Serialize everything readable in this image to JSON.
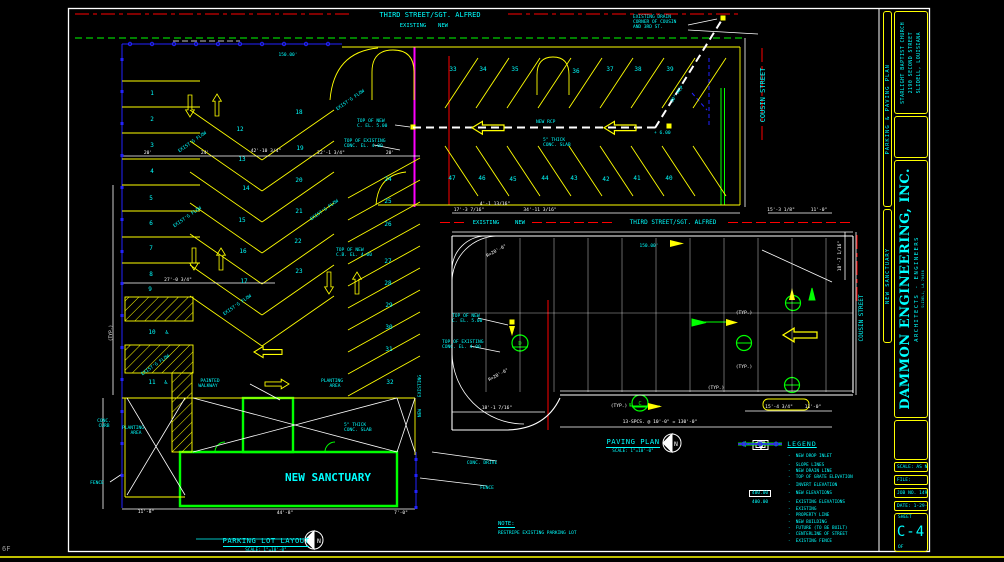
{
  "page": {
    "corner_note": "6F",
    "bg": "#000000"
  },
  "colors": {
    "cyan": "#00ffff",
    "yellow": "#ffff00",
    "green": "#00ff00",
    "red": "#ff0000",
    "magenta": "#ff00ff",
    "blue": "#2222ff",
    "white": "#ffffff"
  },
  "titleblock": {
    "project": "PARKING & PAVING PLAN",
    "drawing": "NEW SANCTUARY",
    "client": [
      "STARLIGHT BAPTIST CHURCH",
      "2190 SECOND STREET",
      "SLIDELL, LOUISIANA"
    ],
    "firm": "DAMMON ENGINEERING, INC.",
    "firm_sub": "ARCHITECTS - ENGINEERS",
    "firm_addr": "SLIDELL, LA 70458",
    "scale": "SCALE: AS NOTED",
    "file": "FILE:",
    "job": "JOB NO. 1495a",
    "date": "DATE: 1-29-04",
    "sheet_label": "SHEET",
    "sheet": "C-4",
    "of": "OF"
  },
  "plans": [
    {
      "name": "PARKING LOT LAYOUT",
      "scale": "SCALE: 1\"=10'-0\"",
      "north": "N"
    },
    {
      "name": "PAVING PLAN",
      "scale": "SCALE: 1\"=10'-0\"",
      "north": "N"
    }
  ],
  "note": {
    "title": "NOTE:",
    "body": "RESTRIPE EXISTING PARKING LOT"
  },
  "legend": {
    "title": "LEGEND",
    "items": [
      {
        "key": "drop-inlet",
        "label": "NEW DROP INLET"
      },
      {
        "key": "slope",
        "label": "SLOPE LINES"
      },
      {
        "key": "drain",
        "label": "NEW DRAIN LINE"
      },
      {
        "key": "grate",
        "label": "TOP OF GRATE ELEVATION"
      },
      {
        "key": "invert",
        "label": "INVERT ELEVATION"
      },
      {
        "key": "new-elev",
        "label": "NEW ELEVATIONS",
        "sample": "400.00"
      },
      {
        "key": "exist-elev",
        "label": "EXISTING ELEVATIONS",
        "sample": "400.00"
      },
      {
        "key": "existing",
        "label": "EXISTING"
      },
      {
        "key": "property",
        "label": "PROPERTY LINE"
      },
      {
        "key": "building",
        "label": "NEW BUILDING"
      },
      {
        "key": "future",
        "label": "FUTURE (TO BE BUILT)"
      },
      {
        "key": "centerline",
        "label": "CENTERLINE OF STREET"
      },
      {
        "key": "fence",
        "label": "EXISTING FENCE"
      }
    ]
  },
  "drawing": {
    "streets": [
      "THIRD STREET/SGT. ALFRED",
      "COUSIN STREET"
    ],
    "labels": [
      {
        "t": "THIRD STREET/SGT. ALFRED",
        "x": 430,
        "y": 17,
        "fs": 7
      },
      {
        "t": "EXISTING",
        "x": 413,
        "y": 27,
        "fs": 5.5
      },
      {
        "t": "NEW",
        "x": 443,
        "y": 27,
        "fs": 5.5
      },
      {
        "t": "EXISTING DRAIN",
        "x": 633,
        "y": 18,
        "fs": 4.5,
        "a": "s"
      },
      {
        "t": "CORNER OF COUSIN",
        "x": 633,
        "y": 23,
        "fs": 4.5,
        "a": "s"
      },
      {
        "t": "AND 3RD ST.",
        "x": 633,
        "y": 28,
        "fs": 4.5,
        "a": "s"
      },
      {
        "t": "COUSIN STREET",
        "x": 765,
        "y": 95,
        "fs": 7,
        "r": -90
      },
      {
        "t": "COUSIN STREET",
        "x": 863,
        "y": 318,
        "fs": 6,
        "r": -90
      },
      {
        "t": "150.00'",
        "x": 288,
        "y": 56,
        "fs": 4.5
      },
      {
        "t": "150.00'",
        "x": 649,
        "y": 247,
        "fs": 4.5
      },
      {
        "t": "THIRD STREET/SGT. ALFRED",
        "x": 673,
        "y": 224,
        "fs": 6
      },
      {
        "t": "EXISTING",
        "x": 486,
        "y": 224,
        "fs": 5.5
      },
      {
        "t": "NEW",
        "x": 520,
        "y": 224,
        "fs": 5.5
      },
      {
        "t": "1",
        "x": 152,
        "y": 95,
        "fs": 6
      },
      {
        "t": "2",
        "x": 152,
        "y": 121,
        "fs": 6
      },
      {
        "t": "3",
        "x": 152,
        "y": 147,
        "fs": 6
      },
      {
        "t": "4",
        "x": 152,
        "y": 173,
        "fs": 6
      },
      {
        "t": "5",
        "x": 151,
        "y": 200,
        "fs": 6
      },
      {
        "t": "6",
        "x": 151,
        "y": 225,
        "fs": 6
      },
      {
        "t": "7",
        "x": 151,
        "y": 250,
        "fs": 6
      },
      {
        "t": "8",
        "x": 151,
        "y": 276,
        "fs": 6
      },
      {
        "t": "9",
        "x": 150,
        "y": 291,
        "fs": 6
      },
      {
        "t": "10",
        "x": 152,
        "y": 334,
        "fs": 6
      },
      {
        "t": "11",
        "x": 152,
        "y": 384,
        "fs": 6
      },
      {
        "t": "♿",
        "x": 167,
        "y": 334,
        "fs": 6
      },
      {
        "t": "♿",
        "x": 166,
        "y": 384,
        "fs": 6
      },
      {
        "t": "12",
        "x": 240,
        "y": 131,
        "fs": 6
      },
      {
        "t": "13",
        "x": 242,
        "y": 161,
        "fs": 6
      },
      {
        "t": "14",
        "x": 246,
        "y": 190,
        "fs": 6
      },
      {
        "t": "15",
        "x": 242,
        "y": 222,
        "fs": 6
      },
      {
        "t": "16",
        "x": 243,
        "y": 253,
        "fs": 6
      },
      {
        "t": "17",
        "x": 244,
        "y": 283,
        "fs": 6
      },
      {
        "t": "18",
        "x": 299,
        "y": 114,
        "fs": 6
      },
      {
        "t": "19",
        "x": 300,
        "y": 150,
        "fs": 6
      },
      {
        "t": "20",
        "x": 299,
        "y": 182,
        "fs": 6
      },
      {
        "t": "21",
        "x": 299,
        "y": 213,
        "fs": 6
      },
      {
        "t": "22",
        "x": 298,
        "y": 243,
        "fs": 6
      },
      {
        "t": "23",
        "x": 299,
        "y": 273,
        "fs": 6
      },
      {
        "t": "24",
        "x": 388,
        "y": 181,
        "fs": 6
      },
      {
        "t": "25",
        "x": 388,
        "y": 203,
        "fs": 6
      },
      {
        "t": "26",
        "x": 388,
        "y": 226,
        "fs": 6
      },
      {
        "t": "27",
        "x": 388,
        "y": 263,
        "fs": 6
      },
      {
        "t": "28",
        "x": 388,
        "y": 285,
        "fs": 6
      },
      {
        "t": "29",
        "x": 389,
        "y": 307,
        "fs": 6
      },
      {
        "t": "30",
        "x": 389,
        "y": 329,
        "fs": 6
      },
      {
        "t": "31",
        "x": 389,
        "y": 351,
        "fs": 6
      },
      {
        "t": "32",
        "x": 390,
        "y": 384,
        "fs": 6
      },
      {
        "t": "33",
        "x": 453,
        "y": 71,
        "fs": 6
      },
      {
        "t": "34",
        "x": 483,
        "y": 71,
        "fs": 6
      },
      {
        "t": "35",
        "x": 515,
        "y": 71,
        "fs": 6
      },
      {
        "t": "36",
        "x": 576,
        "y": 73,
        "fs": 6
      },
      {
        "t": "37",
        "x": 610,
        "y": 71,
        "fs": 6
      },
      {
        "t": "38",
        "x": 638,
        "y": 71,
        "fs": 6
      },
      {
        "t": "39",
        "x": 670,
        "y": 71,
        "fs": 6
      },
      {
        "t": "40",
        "x": 669,
        "y": 180,
        "fs": 6
      },
      {
        "t": "41",
        "x": 637,
        "y": 180,
        "fs": 6
      },
      {
        "t": "42",
        "x": 606,
        "y": 181,
        "fs": 6
      },
      {
        "t": "43",
        "x": 574,
        "y": 180,
        "fs": 6
      },
      {
        "t": "44",
        "x": 545,
        "y": 180,
        "fs": 6
      },
      {
        "t": "45",
        "x": 513,
        "y": 181,
        "fs": 6
      },
      {
        "t": "46",
        "x": 482,
        "y": 180,
        "fs": 6
      },
      {
        "t": "47",
        "x": 452,
        "y": 180,
        "fs": 6
      },
      {
        "t": "TOP OF NEW",
        "x": 357,
        "y": 122,
        "a": "s"
      },
      {
        "t": "C. EL. 5.00",
        "x": 357,
        "y": 127,
        "a": "s"
      },
      {
        "t": "TOP OF EXISTING",
        "x": 344,
        "y": 142,
        "a": "s"
      },
      {
        "t": "CONC. EL. 4.00",
        "x": 344,
        "y": 147,
        "a": "s"
      },
      {
        "t": "TOP OF NEW",
        "x": 336,
        "y": 251,
        "a": "s"
      },
      {
        "t": "C.B. EL. 4.00",
        "x": 336,
        "y": 256,
        "a": "s"
      },
      {
        "t": "TOP OF NEW",
        "x": 452,
        "y": 317,
        "a": "s"
      },
      {
        "t": "C. EL. 5.00",
        "x": 452,
        "y": 322,
        "a": "s"
      },
      {
        "t": "TOP OF EXISTING",
        "x": 442,
        "y": 343,
        "a": "s"
      },
      {
        "t": "CONC. EL. 4.00",
        "x": 442,
        "y": 348,
        "a": "s"
      },
      {
        "t": "NEW RCP",
        "x": 536,
        "y": 123,
        "a": "s"
      },
      {
        "t": "5\" THICK",
        "x": 543,
        "y": 141,
        "a": "s"
      },
      {
        "t": "CONC. SLAB",
        "x": 543,
        "y": 146,
        "a": "s"
      },
      {
        "t": "5\" THICK",
        "x": 344,
        "y": 426,
        "a": "s"
      },
      {
        "t": "CONC. SLAB",
        "x": 344,
        "y": 431,
        "a": "s"
      },
      {
        "t": "+ 6.00",
        "x": 654,
        "y": 134,
        "a": "s"
      },
      {
        "t": "30\" RCP",
        "x": 678,
        "y": 95,
        "r": -55
      },
      {
        "t": "PLANTING",
        "x": 133,
        "y": 429
      },
      {
        "t": "AREA",
        "x": 136,
        "y": 434
      },
      {
        "t": "PLANTING",
        "x": 332,
        "y": 382
      },
      {
        "t": "AREA",
        "x": 335,
        "y": 387
      },
      {
        "t": "PAINTED",
        "x": 210,
        "y": 382
      },
      {
        "t": "WALKWAY",
        "x": 208,
        "y": 387
      },
      {
        "t": "CONC.",
        "x": 104,
        "y": 422
      },
      {
        "t": "CURB",
        "x": 104,
        "y": 427
      },
      {
        "t": "FENCE",
        "x": 97,
        "y": 484
      },
      {
        "t": "FENCE",
        "x": 487,
        "y": 489
      },
      {
        "t": "CONC. DRIVE",
        "x": 482,
        "y": 464
      },
      {
        "t": "NEW SANCTUARY",
        "x": 328,
        "y": 481,
        "fs": 11,
        "b": 1
      },
      {
        "t": "EXISTING",
        "x": 421,
        "y": 386,
        "r": -90
      },
      {
        "t": "NEW",
        "x": 421,
        "y": 413,
        "r": -90
      },
      {
        "t": "EXIST'G FLOW",
        "x": 193,
        "y": 143,
        "r": -35
      },
      {
        "t": "EXIST'G FLOW",
        "x": 188,
        "y": 218,
        "r": -35
      },
      {
        "t": "EXIST'G FLOW",
        "x": 325,
        "y": 211,
        "r": -35
      },
      {
        "t": "EXIST'G FLOW",
        "x": 351,
        "y": 101,
        "r": -35
      },
      {
        "t": "EXIST'G FLOW",
        "x": 238,
        "y": 306,
        "r": -35
      },
      {
        "t": "EXIST'G FLOW",
        "x": 156,
        "y": 366,
        "r": -35
      },
      {
        "t": "20'",
        "x": 148,
        "y": 154,
        "c": "w"
      },
      {
        "t": "24'",
        "x": 205,
        "y": 154,
        "c": "w"
      },
      {
        "t": "42'-10 3/4\"",
        "x": 266,
        "y": 152,
        "c": "w"
      },
      {
        "t": "22'-1 3/4\"",
        "x": 331,
        "y": 154,
        "c": "w"
      },
      {
        "t": "20'",
        "x": 390,
        "y": 154,
        "c": "w"
      },
      {
        "t": "27'-0 3/4\"",
        "x": 178,
        "y": 281,
        "c": "w"
      },
      {
        "t": "(TYP.)",
        "x": 112,
        "y": 333,
        "c": "w",
        "r": -90
      },
      {
        "t": "11'-8\"",
        "x": 146,
        "y": 513,
        "c": "w"
      },
      {
        "t": "44'-8\"",
        "x": 285,
        "y": 514,
        "c": "w"
      },
      {
        "t": "7'-0\"",
        "x": 401,
        "y": 514,
        "c": "w"
      },
      {
        "t": "17'-3 7/16\"",
        "x": 469,
        "y": 211,
        "c": "w"
      },
      {
        "t": "4'-1 13/16\"",
        "x": 495,
        "y": 205,
        "c": "w"
      },
      {
        "t": "34'-11 3/16\"",
        "x": 540,
        "y": 211,
        "c": "w"
      },
      {
        "t": "15'-3 1/8\"",
        "x": 781,
        "y": 211,
        "c": "w"
      },
      {
        "t": "11'-0\"",
        "x": 819,
        "y": 211,
        "c": "w"
      },
      {
        "t": "18'-7 1/16\"",
        "x": 841,
        "y": 256,
        "c": "w",
        "r": -90
      },
      {
        "t": "18'-1 7/16\"",
        "x": 497,
        "y": 409,
        "c": "w"
      },
      {
        "t": "15'-4 3/4\"",
        "x": 779,
        "y": 408,
        "c": "w"
      },
      {
        "t": "11'-0\"",
        "x": 813,
        "y": 408,
        "c": "w"
      },
      {
        "t": "13-SPCS. @ 10'-0\" = 130'-0\"",
        "x": 660,
        "y": 423,
        "c": "w"
      },
      {
        "t": "R=20'-0\"",
        "x": 497,
        "y": 252,
        "c": "w",
        "r": -28
      },
      {
        "t": "R=20'-0\"",
        "x": 499,
        "y": 376,
        "c": "w",
        "r": -28
      },
      {
        "t": "(TYP.)",
        "x": 619,
        "y": 407,
        "c": "w"
      },
      {
        "t": "(TYP.)",
        "x": 744,
        "y": 314,
        "c": "w"
      },
      {
        "t": "(TYP.)",
        "x": 744,
        "y": 368,
        "c": "w"
      },
      {
        "t": "(TYP.)",
        "x": 716,
        "y": 389,
        "c": "w"
      },
      {
        "t": "N",
        "x": 319,
        "y": 543,
        "c": "w",
        "fs": 6.5
      },
      {
        "t": "N",
        "x": 676,
        "y": 446,
        "c": "w",
        "fs": 6.5
      },
      {
        "t": "D",
        "x": 520,
        "y": 345,
        "c": "g",
        "fs": 5.5
      },
      {
        "t": "C",
        "x": 640,
        "y": 405,
        "c": "g",
        "fs": 5.5
      }
    ]
  }
}
